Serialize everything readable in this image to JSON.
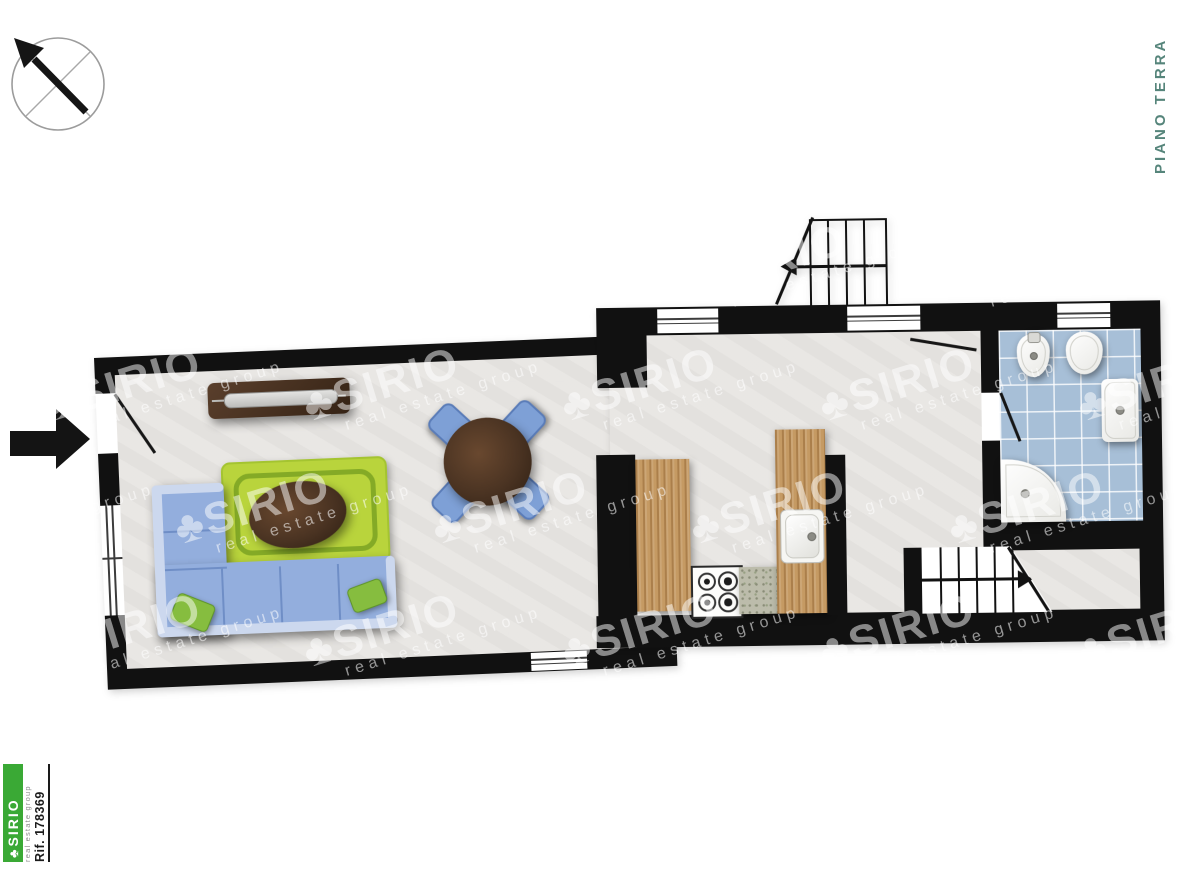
{
  "annotations": {
    "floor_label": "PIANO TERRA"
  },
  "branding": {
    "logo_clover": "♣",
    "logo_text": "SIRIO",
    "tagline": "real estate group",
    "reference": "Rif. 178369"
  },
  "watermark": {
    "clover": "♣",
    "brand": "SIRIO",
    "tagline": "real estate group"
  },
  "icons": {
    "compass": "compass-rose-north-west",
    "entrance": "entrance-arrow-right"
  },
  "colors": {
    "wall": "#111111",
    "floor": "#e8e6e3",
    "tile_blue": "#a7bfd7",
    "wood": "#c59a63",
    "sofa_blue": "#93aedd",
    "rug_green": "#b9d43c",
    "table_brown": "#4a3322",
    "chair_blue": "#7ea0d6",
    "pillow_green": "#86bd3f",
    "logo_green": "#3aa935",
    "floor_label_teal": "#56857b"
  }
}
